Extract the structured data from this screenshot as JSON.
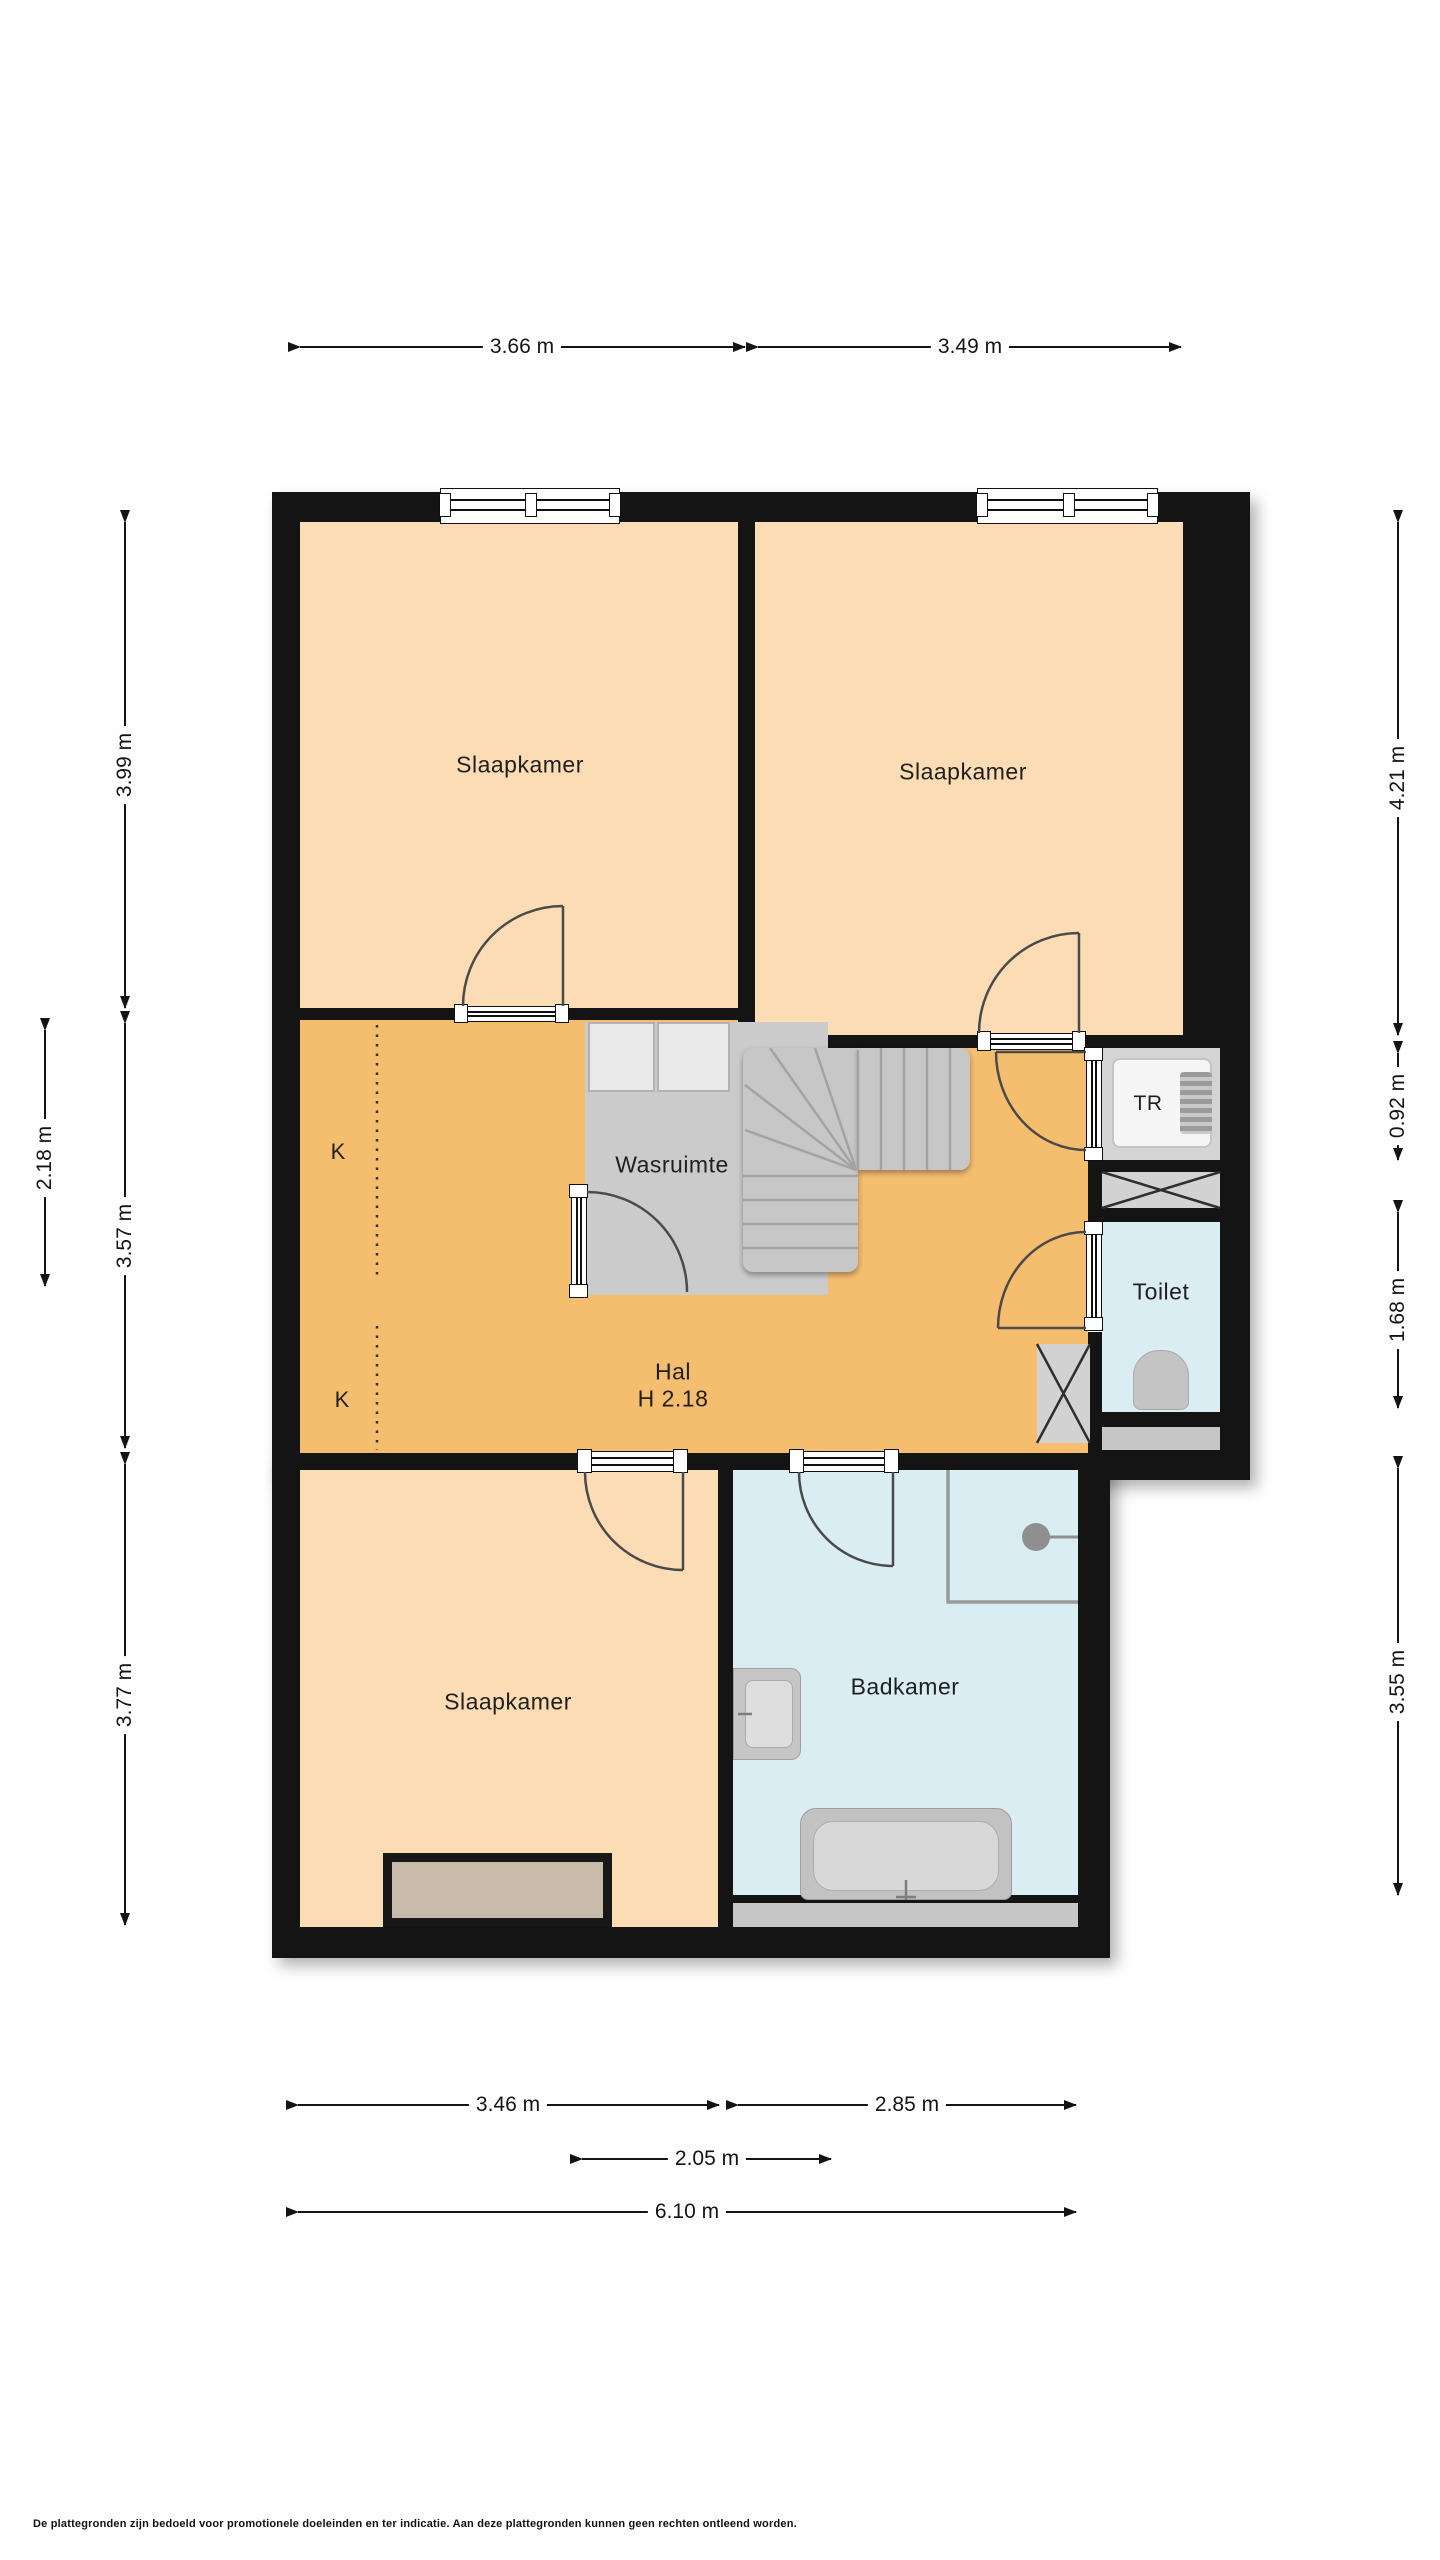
{
  "plan": {
    "type": "floorplan",
    "language": "nl",
    "rooms": {
      "slaapkamer_tl": {
        "label": "Slaapkamer"
      },
      "slaapkamer_tr": {
        "label": "Slaapkamer"
      },
      "slaapkamer_bottom": {
        "label": "Slaapkamer"
      },
      "wasruimte": {
        "label": "Wasruimte"
      },
      "hal": {
        "label": "Hal",
        "ceiling_height": "H 2.18"
      },
      "toilet": {
        "label": "Toilet"
      },
      "badkamer": {
        "label": "Badkamer"
      },
      "technische_ruimte": {
        "label": "TR"
      },
      "kast_1": {
        "label": "K"
      },
      "kast_2": {
        "label": "K"
      }
    },
    "dims": [
      "3.66 m",
      "3.49 m",
      "3.99 m",
      "2.18 m",
      "3.57 m",
      "3.77 m",
      "4.21 m",
      "0.92 m",
      "1.68 m",
      "3.55 m",
      "3.46 m",
      "2.85 m",
      "2.05 m",
      "6.10 m"
    ],
    "disclaimer": "De plattegronden zijn bedoeld voor promotionele doeleinden en ter indicatie. Aan deze plattegronden kunnen geen rechten ontleend worden.",
    "colors": {
      "wall": "#141414",
      "bedroom_floor": "#FBDCB4",
      "hall_floor": "#F5BE6F",
      "wet_room_floor": "#D9EDF3",
      "utility_floor": "#CBCBCB",
      "accent_lines": "#4a4a4a"
    }
  }
}
